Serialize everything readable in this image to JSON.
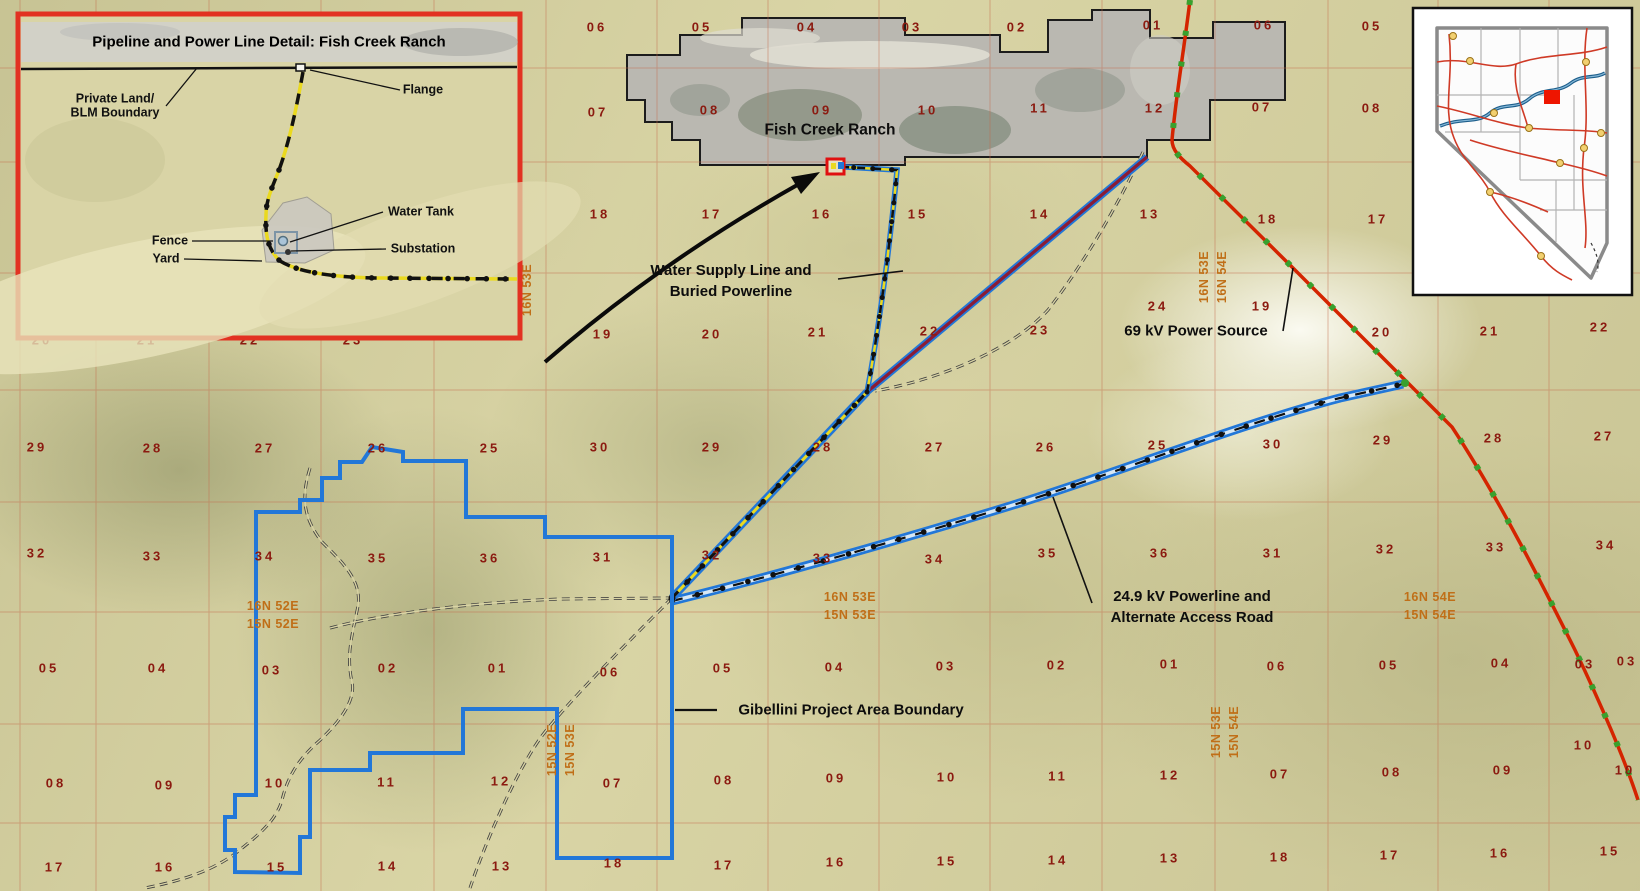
{
  "inset_detail": {
    "title": "Pipeline and Power Line Detail: Fish Creek Ranch",
    "labels": {
      "private_land_1": "Private Land/",
      "private_land_2": "BLM Boundary",
      "flange": "Flange",
      "water_tank": "Water Tank",
      "fence": "Fence",
      "substation": "Substation",
      "yard": "Yard"
    }
  },
  "feature_labels": {
    "fish_creek_ranch": "Fish Creek Ranch",
    "water_supply_line_1": "Water Supply Line and",
    "water_supply_line_2": "Buried Powerline",
    "power_source": "69 kV Power Source",
    "powerline_1": "24.9 kV Powerline and",
    "powerline_2": "Alternate Access Road",
    "gibellini": "Gibellini Project Area Boundary"
  },
  "section_numbers": [
    [
      597,
      27,
      "06"
    ],
    [
      702,
      27,
      "05"
    ],
    [
      807,
      27,
      "04"
    ],
    [
      912,
      27,
      "03"
    ],
    [
      1017,
      27,
      "02"
    ],
    [
      1153,
      25,
      "01"
    ],
    [
      1264,
      25,
      "06"
    ],
    [
      1372,
      26,
      "05"
    ],
    [
      598,
      112,
      "07"
    ],
    [
      710,
      110,
      "08"
    ],
    [
      822,
      110,
      "09"
    ],
    [
      928,
      110,
      "10"
    ],
    [
      1040,
      108,
      "11"
    ],
    [
      1155,
      108,
      "12"
    ],
    [
      1262,
      107,
      "07"
    ],
    [
      1372,
      108,
      "08"
    ],
    [
      600,
      214,
      "18"
    ],
    [
      712,
      214,
      "17"
    ],
    [
      822,
      214,
      "16"
    ],
    [
      918,
      214,
      "15"
    ],
    [
      1040,
      214,
      "14"
    ],
    [
      1150,
      214,
      "13"
    ],
    [
      1268,
      219,
      "18"
    ],
    [
      1378,
      219,
      "17"
    ],
    [
      42,
      340,
      "20"
    ],
    [
      147,
      340,
      "21"
    ],
    [
      250,
      340,
      "22"
    ],
    [
      353,
      340,
      "23"
    ],
    [
      603,
      334,
      "19"
    ],
    [
      712,
      334,
      "20"
    ],
    [
      818,
      332,
      "21"
    ],
    [
      930,
      331,
      "22"
    ],
    [
      1040,
      330,
      "23"
    ],
    [
      1158,
      306,
      "24"
    ],
    [
      1262,
      306,
      "19"
    ],
    [
      1382,
      332,
      "20"
    ],
    [
      1490,
      331,
      "21"
    ],
    [
      1600,
      327,
      "22"
    ],
    [
      37,
      447,
      "29"
    ],
    [
      153,
      448,
      "28"
    ],
    [
      265,
      448,
      "27"
    ],
    [
      378,
      448,
      "26"
    ],
    [
      490,
      448,
      "25"
    ],
    [
      600,
      447,
      "30"
    ],
    [
      712,
      447,
      "29"
    ],
    [
      823,
      447,
      "28"
    ],
    [
      935,
      447,
      "27"
    ],
    [
      1046,
      447,
      "26"
    ],
    [
      1158,
      445,
      "25"
    ],
    [
      1273,
      444,
      "30"
    ],
    [
      1383,
      440,
      "29"
    ],
    [
      1494,
      438,
      "28"
    ],
    [
      1604,
      436,
      "27"
    ],
    [
      37,
      553,
      "32"
    ],
    [
      153,
      556,
      "33"
    ],
    [
      265,
      556,
      "34"
    ],
    [
      378,
      558,
      "35"
    ],
    [
      490,
      558,
      "36"
    ],
    [
      603,
      557,
      "31"
    ],
    [
      712,
      555,
      "32"
    ],
    [
      823,
      558,
      "33"
    ],
    [
      935,
      559,
      "34"
    ],
    [
      1048,
      553,
      "35"
    ],
    [
      1160,
      553,
      "36"
    ],
    [
      1273,
      553,
      "31"
    ],
    [
      1386,
      549,
      "32"
    ],
    [
      1496,
      547,
      "33"
    ],
    [
      1606,
      545,
      "34"
    ],
    [
      49,
      668,
      "05"
    ],
    [
      158,
      668,
      "04"
    ],
    [
      272,
      670,
      "03"
    ],
    [
      388,
      668,
      "02"
    ],
    [
      498,
      668,
      "01"
    ],
    [
      610,
      672,
      "06"
    ],
    [
      723,
      668,
      "05"
    ],
    [
      835,
      667,
      "04"
    ],
    [
      946,
      666,
      "03"
    ],
    [
      1057,
      665,
      "02"
    ],
    [
      1170,
      664,
      "01"
    ],
    [
      1277,
      666,
      "06"
    ],
    [
      1389,
      665,
      "05"
    ],
    [
      1501,
      663,
      "04"
    ],
    [
      1585,
      664,
      "03"
    ],
    [
      1627,
      661,
      "03"
    ],
    [
      56,
      783,
      "08"
    ],
    [
      165,
      785,
      "09"
    ],
    [
      275,
      783,
      "10"
    ],
    [
      387,
      782,
      "11"
    ],
    [
      501,
      781,
      "12"
    ],
    [
      613,
      783,
      "07"
    ],
    [
      724,
      780,
      "08"
    ],
    [
      836,
      778,
      "09"
    ],
    [
      947,
      777,
      "10"
    ],
    [
      1058,
      776,
      "11"
    ],
    [
      1170,
      775,
      "12"
    ],
    [
      1280,
      774,
      "07"
    ],
    [
      1392,
      772,
      "08"
    ],
    [
      1503,
      770,
      "09"
    ],
    [
      1584,
      745,
      "10"
    ],
    [
      1625,
      770,
      "10"
    ],
    [
      55,
      867,
      "17"
    ],
    [
      165,
      867,
      "16"
    ],
    [
      277,
      867,
      "15"
    ],
    [
      388,
      866,
      "14"
    ],
    [
      502,
      866,
      "13"
    ],
    [
      614,
      863,
      "18"
    ],
    [
      724,
      865,
      "17"
    ],
    [
      836,
      862,
      "16"
    ],
    [
      947,
      861,
      "15"
    ],
    [
      1058,
      860,
      "14"
    ],
    [
      1170,
      858,
      "13"
    ],
    [
      1280,
      857,
      "18"
    ],
    [
      1390,
      855,
      "17"
    ],
    [
      1500,
      853,
      "16"
    ],
    [
      1610,
      851,
      "15"
    ]
  ],
  "township_labels": [
    {
      "t": "16N 53E",
      "x": 527,
      "y": 290,
      "r": true
    },
    {
      "t": "16N 53E",
      "x": 1204,
      "y": 277,
      "r": true
    },
    {
      "t": "16N 54E",
      "x": 1222,
      "y": 277,
      "r": true
    },
    {
      "t": "15N 52E",
      "x": 552,
      "y": 750,
      "r": true
    },
    {
      "t": "15N 53E",
      "x": 570,
      "y": 750,
      "r": true
    },
    {
      "t": "15N 53E",
      "x": 1216,
      "y": 732,
      "r": true
    },
    {
      "t": "15N 54E",
      "x": 1234,
      "y": 732,
      "r": true
    },
    {
      "t": "16N 52E",
      "x": 273,
      "y": 606,
      "r": false
    },
    {
      "t": "15N 52E",
      "x": 273,
      "y": 624,
      "r": false
    },
    {
      "t": "16N 53E",
      "x": 850,
      "y": 597,
      "r": false
    },
    {
      "t": "15N 53E",
      "x": 850,
      "y": 615,
      "r": false
    },
    {
      "t": "16N 54E",
      "x": 1430,
      "y": 597,
      "r": false
    },
    {
      "t": "15N 54E",
      "x": 1430,
      "y": 615,
      "r": false
    }
  ],
  "colors": {
    "project_boundary_blue": "#2277d8",
    "powerline_69kv_red": "#d42400",
    "pole_marker_green": "#39a02e",
    "pipeline_yellow": "#ead91f",
    "buried_powerline_maroon": "#8b1c35",
    "section_number_red": "#8b1a10",
    "township_orange": "#c06f18",
    "inset_border_red": "#e23222",
    "nevada_marker_red": "#ee1500"
  }
}
